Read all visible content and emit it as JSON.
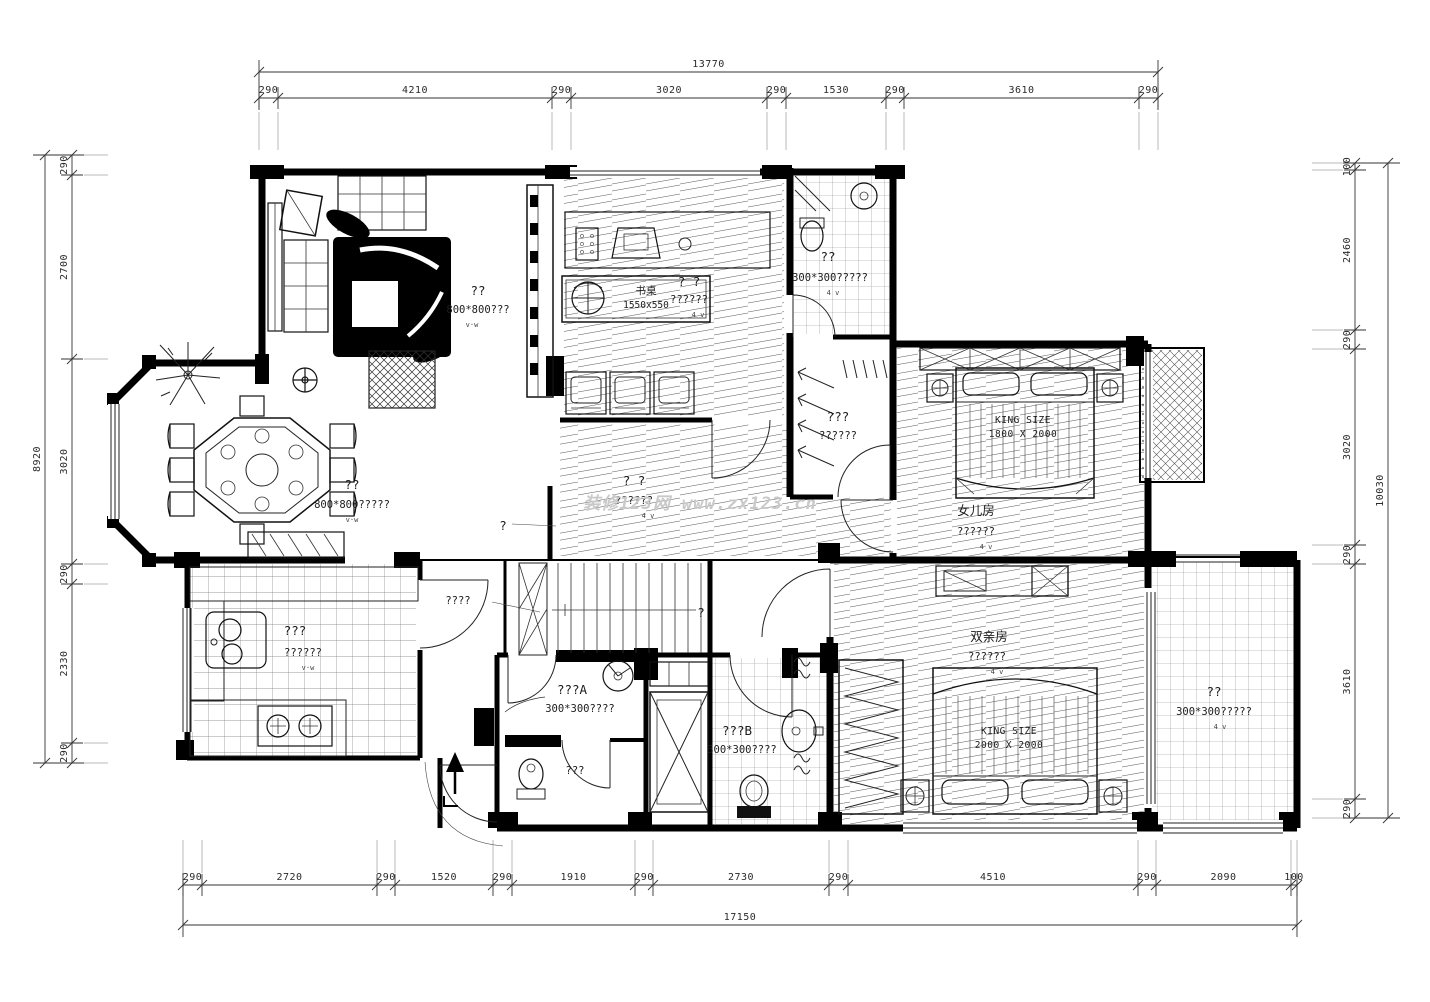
{
  "watermark": "装修123网 www.zx123.cn",
  "dimensions": {
    "top": {
      "total": "13770",
      "segments": [
        "290",
        "4210",
        "290",
        "3020",
        "290",
        "1530",
        "290",
        "3610",
        "290"
      ]
    },
    "bottom": {
      "total": "17150",
      "segments": [
        "290",
        "2720",
        "290",
        "1520",
        "290",
        "1910",
        "290",
        "2730",
        "290",
        "4510",
        "290",
        "2090",
        "100"
      ]
    },
    "left": {
      "total": "8920",
      "segments": [
        "290",
        "2700",
        "3020",
        "290",
        "2330",
        "290"
      ]
    },
    "right": {
      "total": "10030",
      "segments": [
        "100",
        "2460",
        "290",
        "3020",
        "290",
        "3610",
        "290"
      ]
    }
  },
  "rooms": {
    "living": {
      "name": "??",
      "floor": "800*800???",
      "mark": "v·w"
    },
    "dining": {
      "name": "??",
      "floor": "800*800?????",
      "mark": "v·w"
    },
    "kitchen": {
      "name": "???",
      "floor": "??????",
      "mark": "v·w"
    },
    "study": {
      "name": "? ?",
      "floor": "??????",
      "mark": "4 v"
    },
    "desk": {
      "name": "书桌",
      "size": "1550x550"
    },
    "bath_top": {
      "name": "??",
      "floor": "300*300?????",
      "mark": "4 v"
    },
    "closet": {
      "name": "???",
      "floor": "??????"
    },
    "daughter": {
      "name": "女儿房",
      "floor": "??????",
      "mark": "4 v"
    },
    "master": {
      "name": "双亲房",
      "floor": "??????",
      "mark": "4 v"
    },
    "hall": {
      "name": "? ?",
      "floor": "??????",
      "mark": "4 v",
      "pointer": "?"
    },
    "stairs": {
      "label": "????",
      "pointer": "?"
    },
    "bath_a": {
      "name": "???A",
      "floor": "300*300????",
      "wc": "???"
    },
    "bath_b": {
      "name": "???B",
      "floor": "300*300????"
    },
    "balcony_br": {
      "name": "??",
      "floor": "300*300?????",
      "mark": "4 v"
    }
  },
  "beds": {
    "daughter": {
      "line1": "KING SIZE",
      "line2": "1800 X 2000"
    },
    "master": {
      "line1": "KING SIZE",
      "line2": "2000 X 2000"
    }
  }
}
